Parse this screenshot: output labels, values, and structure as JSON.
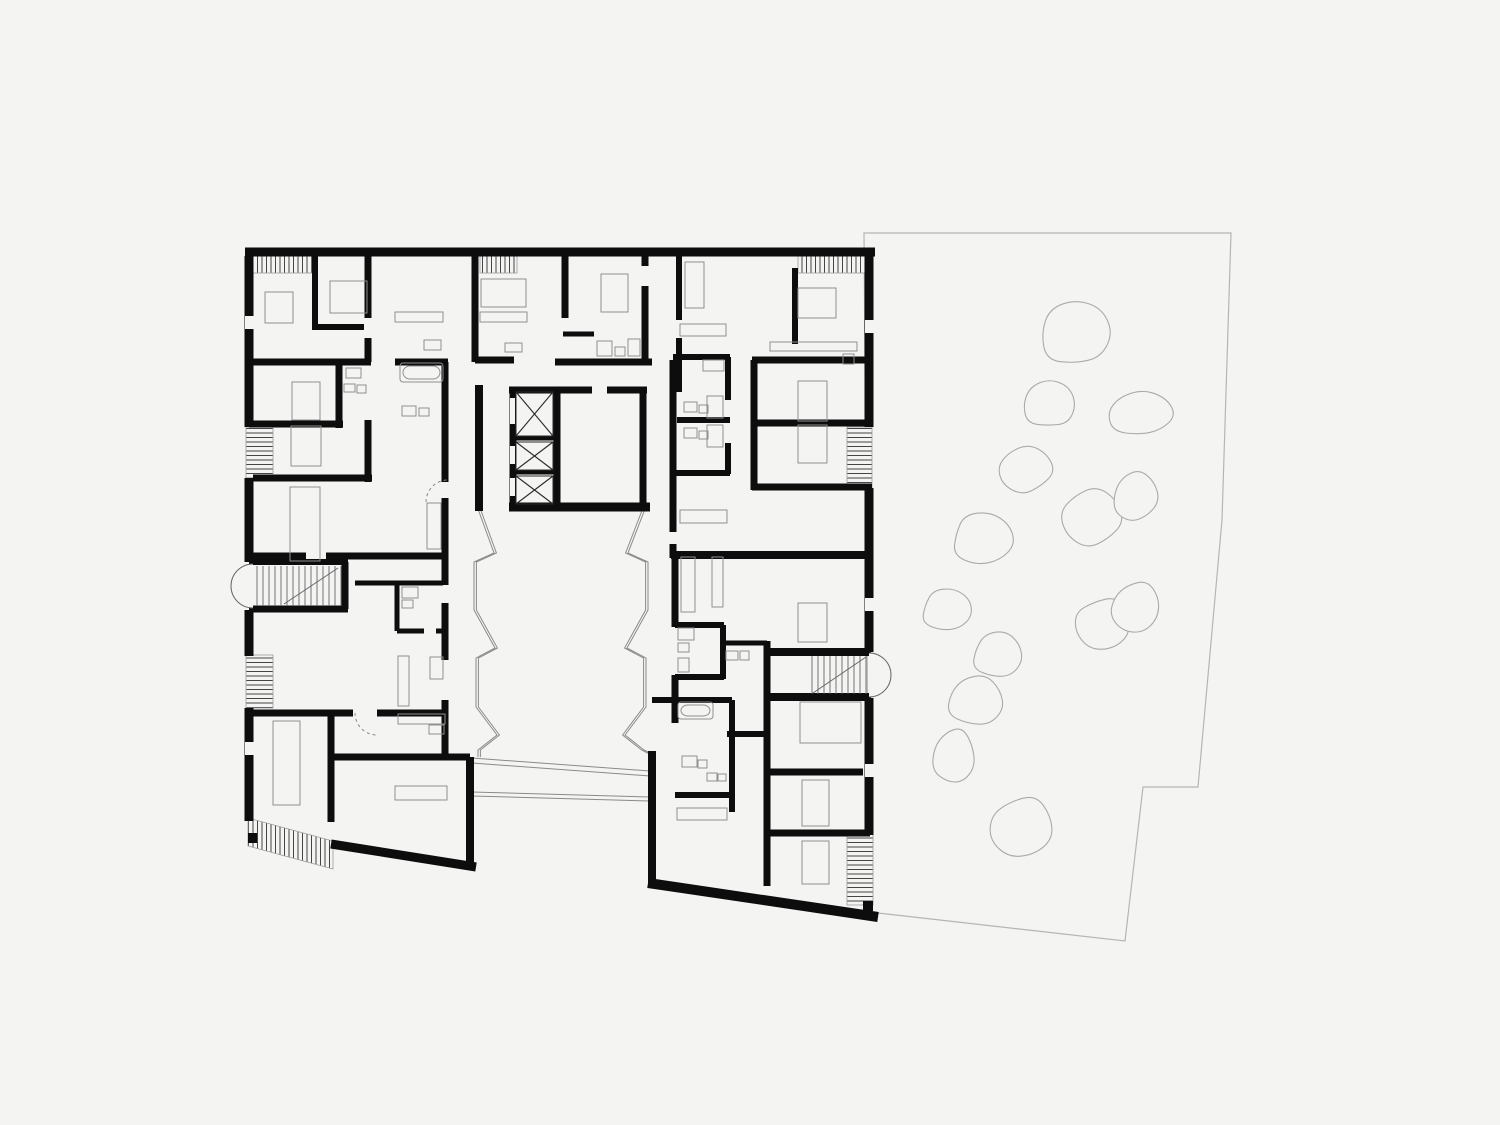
{
  "canvas": {
    "width": 1500,
    "height": 1125,
    "background": "#f4f4f3"
  },
  "palette": {
    "wall": "#0d0d0d",
    "furniture": "#8f8f8f",
    "glazing": "#8a8a8a",
    "site": "#b5b5b5",
    "tree": "#aaaaaa",
    "hatch": "#454545",
    "hatch_border": "#9a9a9a",
    "stair": "#666666",
    "door": "#8a8a8a",
    "background": "#f4f4f3"
  },
  "site": {
    "outline": [
      [
        864,
        233
      ],
      [
        1231,
        233
      ],
      [
        1222,
        520
      ],
      [
        1198,
        787
      ],
      [
        1143,
        787
      ],
      [
        1125,
        941
      ],
      [
        869,
        912
      ]
    ],
    "trees": [
      [
        1075,
        333,
        36,
        34
      ],
      [
        1049,
        404,
        27,
        25
      ],
      [
        1141,
        414,
        34,
        24
      ],
      [
        1026,
        469,
        28,
        24
      ],
      [
        1092,
        517,
        31,
        30
      ],
      [
        1135,
        496,
        24,
        26
      ],
      [
        983,
        539,
        32,
        27
      ],
      [
        947,
        610,
        26,
        22
      ],
      [
        998,
        655,
        26,
        24
      ],
      [
        976,
        701,
        29,
        26
      ],
      [
        954,
        757,
        22,
        29
      ],
      [
        1022,
        827,
        33,
        31
      ],
      [
        1103,
        624,
        29,
        27
      ],
      [
        1135,
        607,
        26,
        27
      ]
    ]
  },
  "walls": [
    [
      245,
      252,
      875,
      252,
      9
    ],
    [
      249,
      256,
      249,
      427,
      9
    ],
    [
      249,
      478,
      249,
      562,
      9
    ],
    [
      249,
      610,
      249,
      656,
      9
    ],
    [
      249,
      708,
      249,
      821,
      9
    ],
    [
      869,
      256,
      869,
      427,
      9
    ],
    [
      869,
      488,
      869,
      652,
      9
    ],
    [
      869,
      698,
      869,
      835,
      9
    ],
    [
      331,
      844,
      476,
      867,
      9
    ],
    [
      470,
      757,
      470,
      864,
      8
    ],
    [
      652,
      751,
      652,
      886,
      8
    ],
    [
      648,
      883,
      878,
      917,
      10
    ],
    [
      479,
      385,
      479,
      511,
      8
    ],
    [
      513,
      387,
      513,
      508,
      7
    ],
    [
      557,
      389,
      557,
      506,
      7
    ],
    [
      643,
      387,
      643,
      508,
      7
    ],
    [
      509,
      390,
      592,
      390,
      7
    ],
    [
      607,
      390,
      647,
      390,
      7
    ],
    [
      509,
      507,
      650,
      507,
      9
    ],
    [
      513,
      438,
      557,
      438,
      5
    ],
    [
      513,
      472,
      557,
      472,
      5
    ],
    [
      368,
      256,
      368,
      362,
      7
    ],
    [
      475,
      256,
      475,
      362,
      7
    ],
    [
      565,
      256,
      565,
      318,
      7
    ],
    [
      645,
      256,
      645,
      364,
      7
    ],
    [
      679,
      256,
      679,
      320,
      6
    ],
    [
      679,
      338,
      679,
      392,
      6
    ],
    [
      754,
      360,
      754,
      490,
      7
    ],
    [
      795,
      268,
      795,
      344,
      6
    ],
    [
      315,
      256,
      315,
      330,
      6
    ],
    [
      315,
      327,
      368,
      327,
      6
    ],
    [
      250,
      362,
      371,
      362,
      7
    ],
    [
      395,
      362,
      448,
      362,
      7
    ],
    [
      475,
      360,
      514,
      360,
      7
    ],
    [
      555,
      362,
      652,
      362,
      7
    ],
    [
      563,
      334,
      594,
      334,
      5
    ],
    [
      673,
      357,
      730,
      357,
      6
    ],
    [
      752,
      360,
      868,
      360,
      7
    ],
    [
      339,
      362,
      339,
      428,
      7
    ],
    [
      249,
      424,
      343,
      424,
      7
    ],
    [
      368,
      420,
      368,
      482,
      7
    ],
    [
      253,
      478,
      372,
      478,
      7
    ],
    [
      445,
      362,
      445,
      482,
      7
    ],
    [
      445,
      498,
      445,
      585,
      7
    ],
    [
      445,
      603,
      445,
      660,
      7
    ],
    [
      445,
      700,
      445,
      760,
      7
    ],
    [
      250,
      556,
      306,
      556,
      7
    ],
    [
      326,
      556,
      448,
      556,
      7
    ],
    [
      249,
      562,
      348,
      562,
      6
    ],
    [
      249,
      609,
      348,
      609,
      7
    ],
    [
      345,
      562,
      345,
      609,
      7
    ],
    [
      250,
      713,
      353,
      713,
      7
    ],
    [
      377,
      713,
      448,
      713,
      7
    ],
    [
      331,
      710,
      331,
      822,
      7
    ],
    [
      331,
      757,
      470,
      757,
      7
    ],
    [
      355,
      583,
      443,
      583,
      5
    ],
    [
      397,
      583,
      397,
      631,
      5
    ],
    [
      397,
      631,
      424,
      631,
      5
    ],
    [
      436,
      631,
      445,
      631,
      5
    ],
    [
      673,
      360,
      673,
      532,
      7
    ],
    [
      673,
      544,
      673,
      558,
      7
    ],
    [
      677,
      420,
      730,
      420,
      6
    ],
    [
      728,
      357,
      728,
      400,
      6
    ],
    [
      728,
      443,
      728,
      474,
      6
    ],
    [
      673,
      473,
      730,
      473,
      6
    ],
    [
      752,
      423,
      866,
      423,
      7
    ],
    [
      752,
      487,
      872,
      487,
      7
    ],
    [
      671,
      555,
      872,
      555,
      8
    ],
    [
      675,
      555,
      675,
      627,
      7
    ],
    [
      675,
      675,
      675,
      723,
      7
    ],
    [
      675,
      625,
      724,
      625,
      6
    ],
    [
      675,
      677,
      724,
      677,
      6
    ],
    [
      723,
      625,
      723,
      679,
      6
    ],
    [
      723,
      643,
      767,
      643,
      5
    ],
    [
      767,
      641,
      767,
      700,
      7
    ],
    [
      767,
      652,
      871,
      652,
      8
    ],
    [
      767,
      697,
      871,
      697,
      8
    ],
    [
      652,
      700,
      732,
      700,
      6
    ],
    [
      732,
      700,
      732,
      812,
      6
    ],
    [
      727,
      734,
      769,
      734,
      6
    ],
    [
      675,
      795,
      732,
      795,
      6
    ],
    [
      767,
      700,
      767,
      886,
      7
    ],
    [
      767,
      772,
      863,
      772,
      7
    ],
    [
      767,
      833,
      870,
      833,
      7
    ]
  ],
  "window_gaps": [
    [
      245,
      316,
      9,
      13
    ],
    [
      245,
      742,
      9,
      13
    ],
    [
      865,
      320,
      9,
      13
    ],
    [
      865,
      598,
      9,
      13
    ],
    [
      865,
      764,
      9,
      13
    ],
    [
      510,
      398,
      5,
      26
    ],
    [
      510,
      446,
      5,
      18
    ],
    [
      510,
      478,
      5,
      18
    ],
    [
      364,
      318,
      8,
      20
    ],
    [
      641,
      266,
      8,
      20
    ]
  ],
  "balconies": {
    "rects": [
      {
        "x": 252,
        "y": 250,
        "w": 60,
        "h": 23,
        "dir": "v"
      },
      {
        "x": 480,
        "y": 250,
        "w": 37,
        "h": 23,
        "dir": "v"
      },
      {
        "x": 798,
        "y": 250,
        "w": 70,
        "h": 23,
        "dir": "v"
      },
      {
        "x": 246,
        "y": 427,
        "w": 27,
        "h": 51,
        "dir": "h"
      },
      {
        "x": 246,
        "y": 655,
        "w": 27,
        "h": 53,
        "dir": "h"
      },
      {
        "x": 847,
        "y": 427,
        "w": 25,
        "h": 61,
        "dir": "h"
      },
      {
        "x": 847,
        "y": 833,
        "w": 26,
        "h": 72,
        "dir": "h"
      }
    ],
    "polygons": [
      {
        "points": [
          [
            248,
            818
          ],
          [
            333,
            841
          ],
          [
            333,
            869
          ],
          [
            248,
            846
          ]
        ],
        "dir": "v"
      }
    ]
  },
  "elevators": {
    "cells": [
      [
        516,
        392,
        37,
        44
      ],
      [
        516,
        442,
        37,
        28
      ],
      [
        516,
        476,
        37,
        28
      ]
    ]
  },
  "stairs": {
    "left": {
      "tread_x1": 257,
      "tread_x2": 341,
      "step": 6,
      "y1": 566,
      "y2": 606,
      "diag": [
        338,
        568,
        284,
        604
      ],
      "arc": "M253,564 A22,22 0 0 0 253,608"
    },
    "right": {
      "tread_x1": 812,
      "tread_x2": 866,
      "step": 6,
      "y1": 656,
      "y2": 694,
      "diag": [
        813,
        693,
        866,
        657
      ],
      "arc": "M869,653 A22,22 0 0 1 869,697"
    }
  },
  "courtyard": {
    "zigzag_west": [
      [
        478,
        509
      ],
      [
        494,
        553
      ],
      [
        474,
        562
      ],
      [
        474,
        610
      ],
      [
        495,
        648
      ],
      [
        476,
        658
      ],
      [
        476,
        707
      ],
      [
        497,
        735
      ],
      [
        478,
        750
      ],
      [
        478,
        757
      ]
    ],
    "zigzag_east": [
      [
        645,
        509
      ],
      [
        628,
        553
      ],
      [
        648,
        562
      ],
      [
        648,
        610
      ],
      [
        627,
        648
      ],
      [
        646,
        658
      ],
      [
        646,
        707
      ],
      [
        625,
        735
      ],
      [
        644,
        750
      ],
      [
        652,
        754
      ]
    ],
    "walkway": [
      [
        472,
        758,
        650,
        771
      ],
      [
        472,
        763,
        650,
        776
      ],
      [
        472,
        792,
        650,
        797
      ],
      [
        472,
        796,
        650,
        801
      ]
    ]
  },
  "furniture": [
    [
      265,
      292,
      28,
      31
    ],
    [
      330,
      281,
      37,
      32
    ],
    [
      395,
      312,
      48,
      10
    ],
    [
      424,
      340,
      17,
      10
    ],
    [
      480,
      312,
      47,
      10
    ],
    [
      481,
      279,
      45,
      28
    ],
    [
      505,
      343,
      17,
      9
    ],
    [
      601,
      274,
      27,
      38
    ],
    [
      597,
      341,
      15,
      15
    ],
    [
      615,
      347,
      10,
      9
    ],
    [
      628,
      339,
      12,
      17
    ],
    [
      685,
      262,
      19,
      46
    ],
    [
      680,
      324,
      46,
      12
    ],
    [
      703,
      360,
      21,
      11
    ],
    [
      770,
      342,
      87,
      9
    ],
    [
      798,
      288,
      38,
      30
    ],
    [
      843,
      354,
      11,
      10
    ],
    [
      292,
      382,
      28,
      38
    ],
    [
      291,
      426,
      30,
      40
    ],
    [
      290,
      487,
      30,
      74
    ],
    [
      346,
      368,
      15,
      10
    ],
    [
      344,
      384,
      11,
      8
    ],
    [
      357,
      385,
      9,
      8
    ],
    [
      402,
      406,
      14,
      10
    ],
    [
      419,
      408,
      10,
      8
    ],
    [
      427,
      503,
      14,
      46
    ],
    [
      398,
      656,
      11,
      50
    ],
    [
      430,
      657,
      13,
      22
    ],
    [
      402,
      587,
      16,
      11
    ],
    [
      402,
      600,
      11,
      8
    ],
    [
      398,
      714,
      47,
      10
    ],
    [
      429,
      725,
      15,
      9
    ],
    [
      395,
      786,
      52,
      14
    ],
    [
      273,
      721,
      27,
      84
    ],
    [
      684,
      402,
      13,
      10
    ],
    [
      699,
      405,
      9,
      8
    ],
    [
      707,
      396,
      16,
      22
    ],
    [
      684,
      428,
      13,
      10
    ],
    [
      699,
      431,
      9,
      8
    ],
    [
      707,
      425,
      16,
      22
    ],
    [
      678,
      628,
      16,
      12
    ],
    [
      678,
      643,
      11,
      9
    ],
    [
      678,
      658,
      11,
      14
    ],
    [
      726,
      651,
      12,
      9
    ],
    [
      740,
      651,
      9,
      9
    ],
    [
      798,
      381,
      29,
      40
    ],
    [
      798,
      425,
      29,
      38
    ],
    [
      798,
      603,
      29,
      39
    ],
    [
      681,
      557,
      14,
      55
    ],
    [
      712,
      557,
      11,
      50
    ],
    [
      680,
      510,
      47,
      13
    ],
    [
      682,
      756,
      15,
      11
    ],
    [
      698,
      760,
      9,
      8
    ],
    [
      707,
      773,
      10,
      8
    ],
    [
      718,
      774,
      8,
      7
    ],
    [
      800,
      702,
      61,
      41
    ],
    [
      802,
      780,
      27,
      46
    ],
    [
      802,
      841,
      27,
      43
    ],
    [
      677,
      808,
      50,
      12
    ]
  ],
  "bathtubs": [
    [
      400,
      363,
      43,
      19
    ],
    [
      678,
      702,
      35,
      17
    ]
  ],
  "door_arcs": [
    "M426,502 A22,22 0 0 1 448,480",
    "M355,713 A22,22 0 0 0 377,735"
  ],
  "corner_blocks": [
    [
      248,
      833,
      9,
      10
    ],
    [
      863,
      901,
      10,
      10
    ]
  ]
}
